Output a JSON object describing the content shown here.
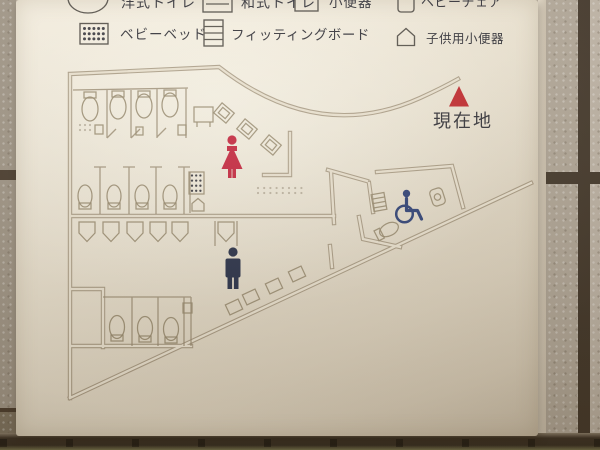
{
  "sign": {
    "kind": "restroom-floor-map-sign",
    "legend": {
      "row1": [
        {
          "icon": "western-toilet-icon",
          "label": "洋式トイレ"
        },
        {
          "icon": "squat-toilet-icon",
          "label": "和式トイレ"
        },
        {
          "icon": "urinal-icon",
          "label": "小便器"
        },
        {
          "icon": "baby-chair-icon",
          "label": "ベビーチェア"
        }
      ],
      "row2": [
        {
          "icon": "baby-bed-icon",
          "label": "ベビーベッド"
        },
        {
          "icon": "fitting-board-icon",
          "label": "フィッティングボード"
        },
        {
          "icon": "child-urinal-icon",
          "label": "子供用小便器"
        }
      ]
    },
    "current_location": {
      "label": "現在地",
      "marker_icon": "red-triangle-icon",
      "marker_color": "#c1272d"
    },
    "pictograms": [
      {
        "name": "woman-pictogram",
        "color": "#c5203b"
      },
      {
        "name": "man-pictogram",
        "color": "#232c47"
      },
      {
        "name": "wheelchair-pictogram",
        "color": "#2b3f77"
      }
    ],
    "map_symbols": [
      "baby-bed-icon",
      "child-urinal-icon",
      "fitting-board-icon"
    ],
    "line_color": "#9c8d76"
  }
}
